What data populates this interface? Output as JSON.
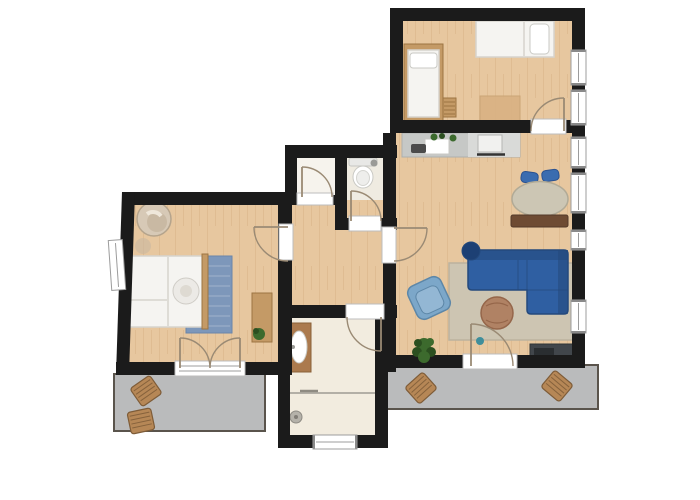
{
  "title": "Apartment floor plan with two bedrooms, open kitchen-living room, hallway, WC, bathroom and two balconies",
  "colors": {
    "wall": "#1b1b1b",
    "wood": "#e7c79f",
    "wood_grain": "#cfa276",
    "tile": "#f2ecdf",
    "tile_wc": "#efebe1",
    "niche_floor": "#f6f3ed",
    "balcony_floor": "#babbbc",
    "balcony_edge": "#5a544c",
    "window_frame": "#9c9c9c",
    "window_tick": "#8a8a8a",
    "threshold_edge": "#bdbdbd",
    "door": "#9a8a74",
    "sofa_blue": "#2f5fa2",
    "sofa_blue_dark": "#24497c",
    "cushion_blue": "#1d4074",
    "armchair_blue": "#7ca7c9",
    "armchair_blue_dark": "#5d87a8",
    "chair_blue": "#3a6cb0",
    "chair_blue_dark": "#2b5290",
    "table_beige": "#ccc6b4",
    "table_beige_dark": "#b1aa96",
    "sideboard_brown": "#6e4b33",
    "rug_beige": "#cdc5b2",
    "rug_beige_dark": "#bcb29e",
    "pouf_brown": "#b08264",
    "pouf_brown_dark": "#95664a",
    "rug_blue": "#7d97ba",
    "rug_blue_dark": "#6a85a9",
    "bed_white": "#f5f4f1",
    "bed_edge": "#d6d3cd",
    "wood_furniture": "#c49a66",
    "wood_furniture_dark": "#9c7443",
    "counter_gray": "#c6c8c6",
    "counter_gray_light": "#d9dad8",
    "appliance_dark": "#4b4b4b",
    "stove_white": "#f1f1ef",
    "plant_green": "#3c6a2d",
    "plant_green_dark": "#2b4f20",
    "vanity_wood": "#ab7a4e",
    "tv_gray": "#41464b",
    "teal": "#3f8e9b",
    "papasan": "#d7c9b6",
    "papasan_dark": "#b5a48c",
    "deck_wood": "#b68756",
    "deck_wood_dark": "#7e5c38",
    "shower_gray": "#b3afa6"
  },
  "rooms": [
    {
      "name": "bedroom-top",
      "floor": "wood",
      "furniture": [
        "double-bed",
        "single-bed",
        "bedside-ladder",
        "play-rug"
      ]
    },
    {
      "name": "kitchen-living-room",
      "floor": "wood",
      "furniture": [
        "kitchen-counter",
        "sink",
        "faucet",
        "cutting-board",
        "herbs",
        "stove",
        "dining-table",
        "dining-chair",
        "dining-chair",
        "sideboard",
        "corner-sofa",
        "round-cushion",
        "armchair",
        "area-rug",
        "pouf",
        "potted-plant",
        "tv-lowboard",
        "vase"
      ]
    },
    {
      "name": "bedroom-left",
      "floor": "wood",
      "furniture": [
        "double-bed",
        "round-pillow",
        "blue-rug",
        "papasan-chair",
        "stool",
        "desk",
        "small-plant"
      ]
    },
    {
      "name": "hallway",
      "floor": "wood",
      "furniture": []
    },
    {
      "name": "storage-niche",
      "floor": "light",
      "furniture": []
    },
    {
      "name": "wc",
      "floor": "tile",
      "furniture": [
        "toilet"
      ]
    },
    {
      "name": "bathroom",
      "floor": "tile",
      "furniture": [
        "vanity-sink",
        "shower",
        "shower-screen"
      ]
    },
    {
      "name": "balcony-left",
      "floor": "concrete",
      "furniture": [
        "deck-chair",
        "deck-chair"
      ]
    },
    {
      "name": "balcony-right",
      "floor": "concrete",
      "furniture": [
        "deck-chair",
        "deck-chair"
      ]
    }
  ],
  "counts": {
    "windows": 9,
    "interior_doors": 6,
    "exterior_doors": 2,
    "balconies": 2
  }
}
